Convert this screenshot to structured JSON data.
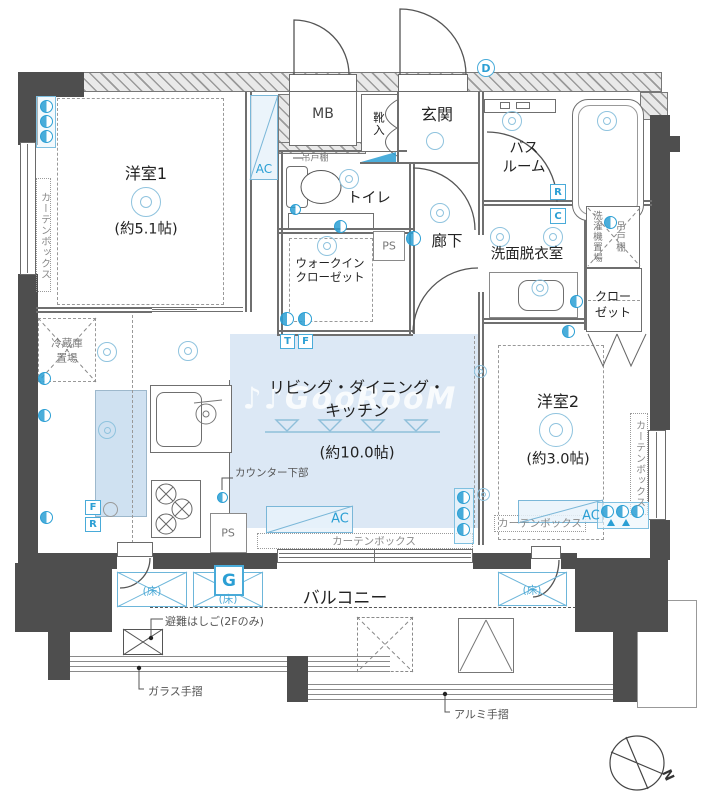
{
  "watermark": "♪♪GooRooM",
  "compass": {
    "north": "N"
  },
  "rooms": {
    "western1": {
      "name": "洋室1",
      "size": "(約5.1帖)"
    },
    "western2": {
      "name": "洋室2",
      "size": "(約3.0帖)"
    },
    "ldk": {
      "name_line1": "リビング・ダイニング・",
      "name_line2": "キッチン",
      "size": "(約10.0帖)"
    },
    "entrance": {
      "name": "玄関"
    },
    "mb": {
      "name": "MB"
    },
    "shoe_box": {
      "name": "靴入"
    },
    "bathroom": {
      "line1": "バス",
      "line2": "ルーム"
    },
    "toilet": {
      "name": "トイレ"
    },
    "hallway": {
      "name": "廊下"
    },
    "wic": {
      "line1": "ウォークイン",
      "line2": "クローゼット"
    },
    "washroom": {
      "name": "洗面脱衣室"
    },
    "laundry": {
      "name": "洗濯機置場"
    },
    "hanging_shelf": {
      "name": "吊戸棚"
    },
    "closet": {
      "line1": "クロー",
      "line2": "ゼット"
    },
    "balcony": {
      "name": "バルコニー"
    },
    "fridge_space": {
      "line1": "冷蔵庫",
      "line2": "置場"
    }
  },
  "labels": {
    "curtain_box": "カーテンボックス",
    "counter_lower": "カウンター下部",
    "evacuation_ladder": "避難はしご(2Fのみ)",
    "glass_handrail": "ガラス手摺",
    "aluminum_handrail": "アルミ手摺",
    "floor_hatch": "(床)"
  },
  "markers": {
    "ac": "AC",
    "ps": "PS",
    "d": "D",
    "r": "R",
    "c": "C",
    "t": "T",
    "f": "F",
    "g": "G",
    "f_kitchen": "F",
    "r_kitchen": "R"
  },
  "colors": {
    "wall": "#4e4e4e",
    "accent_blue": "#2b9fd4",
    "room_fill": "#dce8f5",
    "light_blue_line": "#8fc3de"
  }
}
